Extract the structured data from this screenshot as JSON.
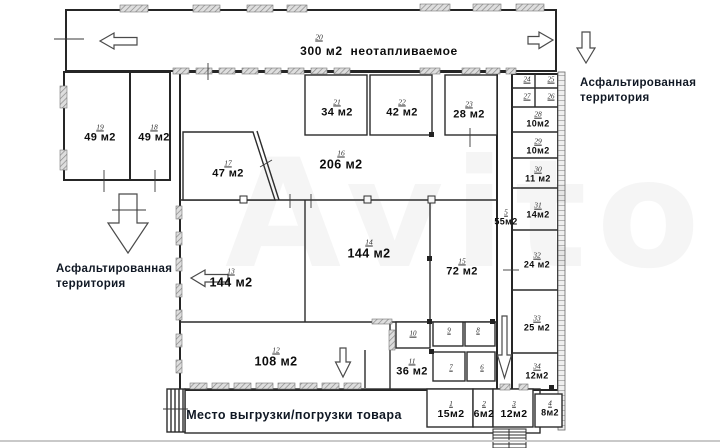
{
  "watermark": "Avito",
  "plan": {
    "top_hall": {
      "number": "20",
      "label": "300 м2  неотапливаемое"
    },
    "dock_label": "Место выгрузки/погрузки товара",
    "territory_left": {
      "line1": "Асфальтированная",
      "line2": "территория"
    },
    "territory_right": {
      "line1": "Асфальтированная",
      "line2": "территория"
    }
  },
  "rooms": [
    {
      "number": "19",
      "area": "49 м2",
      "cx": 100,
      "cy": 134,
      "size": "md"
    },
    {
      "number": "18",
      "area": "49 м2",
      "cx": 154,
      "cy": 134,
      "size": "md"
    },
    {
      "number": "17",
      "area": "47 м2",
      "cx": 228,
      "cy": 170,
      "size": "md"
    },
    {
      "number": "16",
      "area": "206 м2",
      "cx": 341,
      "cy": 161,
      "size": "lg"
    },
    {
      "number": "21",
      "area": "34 м2",
      "cx": 337,
      "cy": 109,
      "size": "md"
    },
    {
      "number": "22",
      "area": "42 м2",
      "cx": 402,
      "cy": 109,
      "size": "md"
    },
    {
      "number": "23",
      "area": "28 м2",
      "cx": 469,
      "cy": 111,
      "size": "md"
    },
    {
      "number": "13",
      "area": "144 м2",
      "cx": 231,
      "cy": 279,
      "size": "lg"
    },
    {
      "number": "14",
      "area": "144 м2",
      "cx": 369,
      "cy": 250,
      "size": "lg"
    },
    {
      "number": "15",
      "area": "72 м2",
      "cx": 462,
      "cy": 268,
      "size": "md"
    },
    {
      "number": "12",
      "area": "108 м2",
      "cx": 276,
      "cy": 358,
      "size": "lg"
    },
    {
      "number": "11",
      "area": "36 м2",
      "cx": 412,
      "cy": 368,
      "size": "md"
    },
    {
      "number": "5",
      "area": "55м2",
      "cx": 506,
      "cy": 218,
      "size": "sm"
    },
    {
      "number": "10",
      "area": "",
      "cx": 413,
      "cy": 334,
      "size": "xs"
    },
    {
      "number": "9",
      "area": "",
      "cx": 449,
      "cy": 331,
      "size": "xs"
    },
    {
      "number": "8",
      "area": "",
      "cx": 478,
      "cy": 331,
      "size": "xs"
    },
    {
      "number": "7",
      "area": "",
      "cx": 451,
      "cy": 368,
      "size": "xs"
    },
    {
      "number": "6",
      "area": "",
      "cx": 482,
      "cy": 368,
      "size": "xs"
    },
    {
      "number": "24",
      "area": "",
      "cx": 527,
      "cy": 80,
      "size": "xs"
    },
    {
      "number": "25",
      "area": "",
      "cx": 551,
      "cy": 80,
      "size": "xs"
    },
    {
      "number": "27",
      "area": "",
      "cx": 527,
      "cy": 97,
      "size": "xs"
    },
    {
      "number": "26",
      "area": "",
      "cx": 551,
      "cy": 97,
      "size": "xs"
    },
    {
      "number": "28",
      "area": "10м2",
      "cx": 538,
      "cy": 120,
      "size": "sm"
    },
    {
      "number": "29",
      "area": "10м2",
      "cx": 538,
      "cy": 147,
      "size": "sm"
    },
    {
      "number": "30",
      "area": "11 м2",
      "cx": 538,
      "cy": 175,
      "size": "sm"
    },
    {
      "number": "31",
      "area": "14м2",
      "cx": 538,
      "cy": 211,
      "size": "sm"
    },
    {
      "number": "32",
      "area": "24 м2",
      "cx": 537,
      "cy": 261,
      "size": "sm"
    },
    {
      "number": "33",
      "area": "25 м2",
      "cx": 537,
      "cy": 324,
      "size": "sm"
    },
    {
      "number": "34",
      "area": "12м2",
      "cx": 537,
      "cy": 372,
      "size": "sm"
    },
    {
      "number": "1",
      "area": "15м2",
      "cx": 451,
      "cy": 410,
      "size": "sm2"
    },
    {
      "number": "2",
      "area": "6м2",
      "cx": 484,
      "cy": 410,
      "size": "sm2"
    },
    {
      "number": "3",
      "area": "12м2",
      "cx": 514,
      "cy": 410,
      "size": "sm2"
    },
    {
      "number": "4",
      "area": "8м2",
      "cx": 550,
      "cy": 409,
      "size": "sm"
    }
  ]
}
